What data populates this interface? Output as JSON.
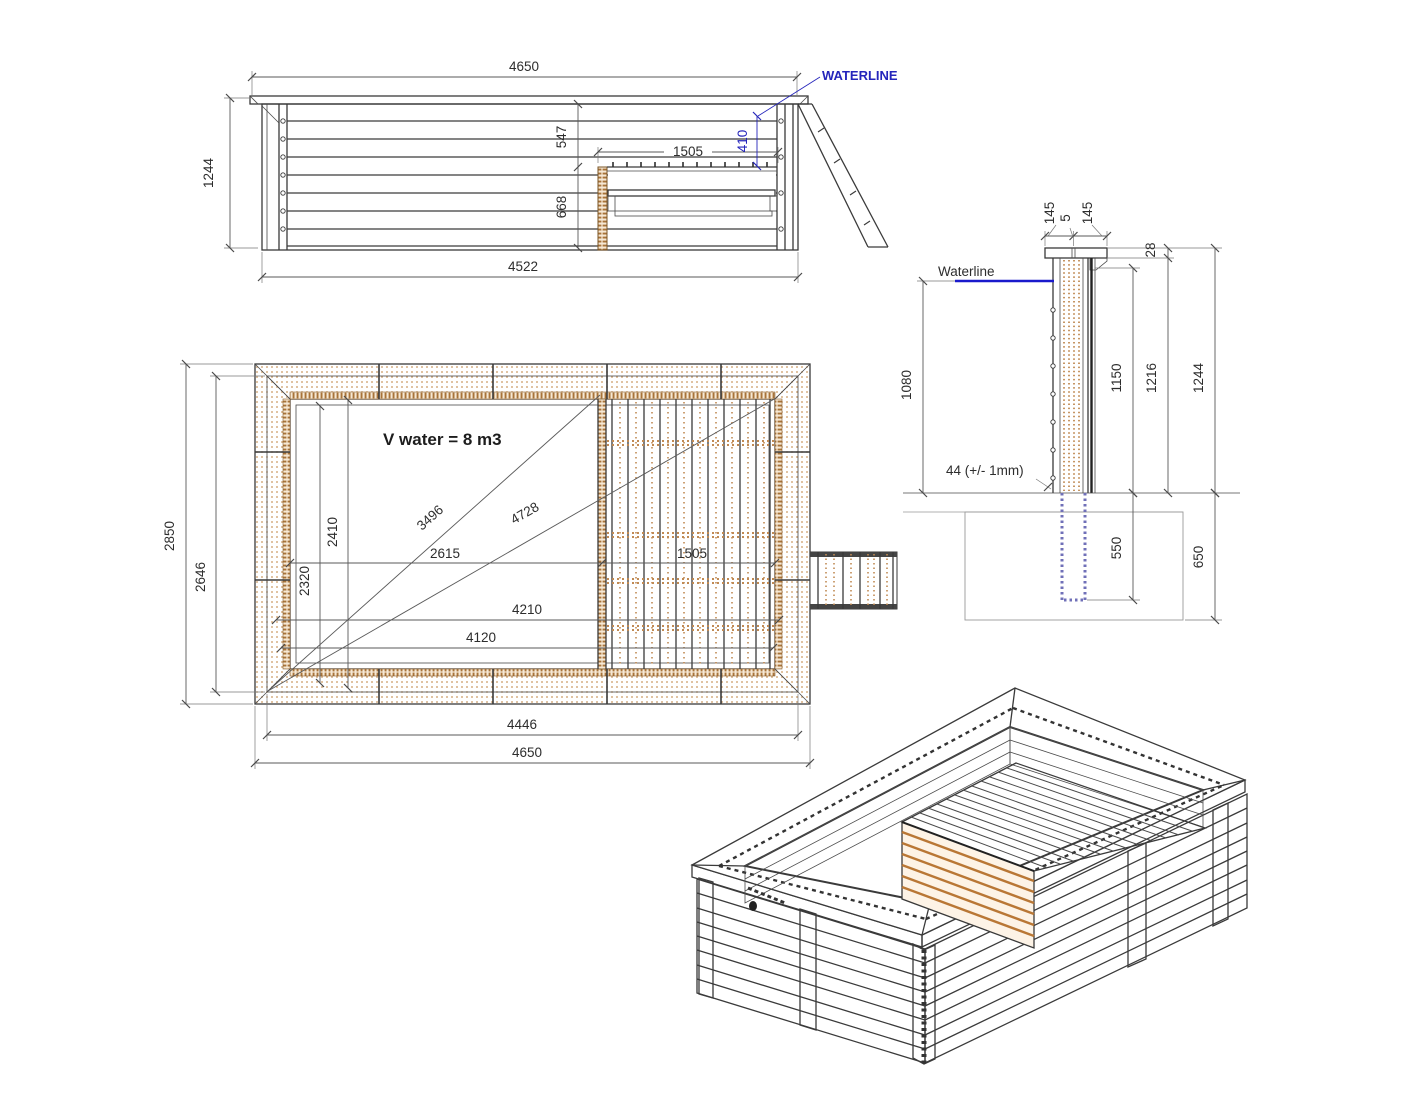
{
  "drawing_title": "wooden-pool-technical-drawing",
  "colors": {
    "line": "#3a3a3a",
    "accent_blue": "#2525bb",
    "wood_tan": "#c08a54",
    "wood_dark": "#9a6a33",
    "anchor_purple": "#7070b8",
    "background": "#ffffff"
  },
  "side_view": {
    "waterline_label": "WATERLINE",
    "dims": {
      "top_width": "4650",
      "height": "1244",
      "top_to_deck": "547",
      "deck_length": "1505",
      "waterline_to_deck": "410",
      "deck_to_floor": "668",
      "bottom_width": "4522"
    }
  },
  "plan_view": {
    "volume_label": "V water = 8 m3",
    "dims": {
      "outer_width": "2850",
      "wall_width": "2646",
      "inner_width": "2410",
      "inner_width_min": "2320",
      "diagonal_to_divider": "3496",
      "diagonal_full": "4728",
      "left_to_deck": "2615",
      "deck_length": "1505",
      "inner_length": "4210",
      "inner_length_min": "4120",
      "wall_length": "4446",
      "outer_length": "4650"
    }
  },
  "section_view": {
    "waterline_label": "Waterline",
    "plank_note": "44 (+/- 1mm)",
    "dims": {
      "coping_outer": "145",
      "coping_gap": "5",
      "coping_inner": "145",
      "coping_thickness": "28",
      "water_depth": "1080",
      "inner_height": "1150",
      "wall_height": "1216",
      "total_height": "1244",
      "anchor_depth": "550",
      "foundation_depth": "650"
    }
  }
}
